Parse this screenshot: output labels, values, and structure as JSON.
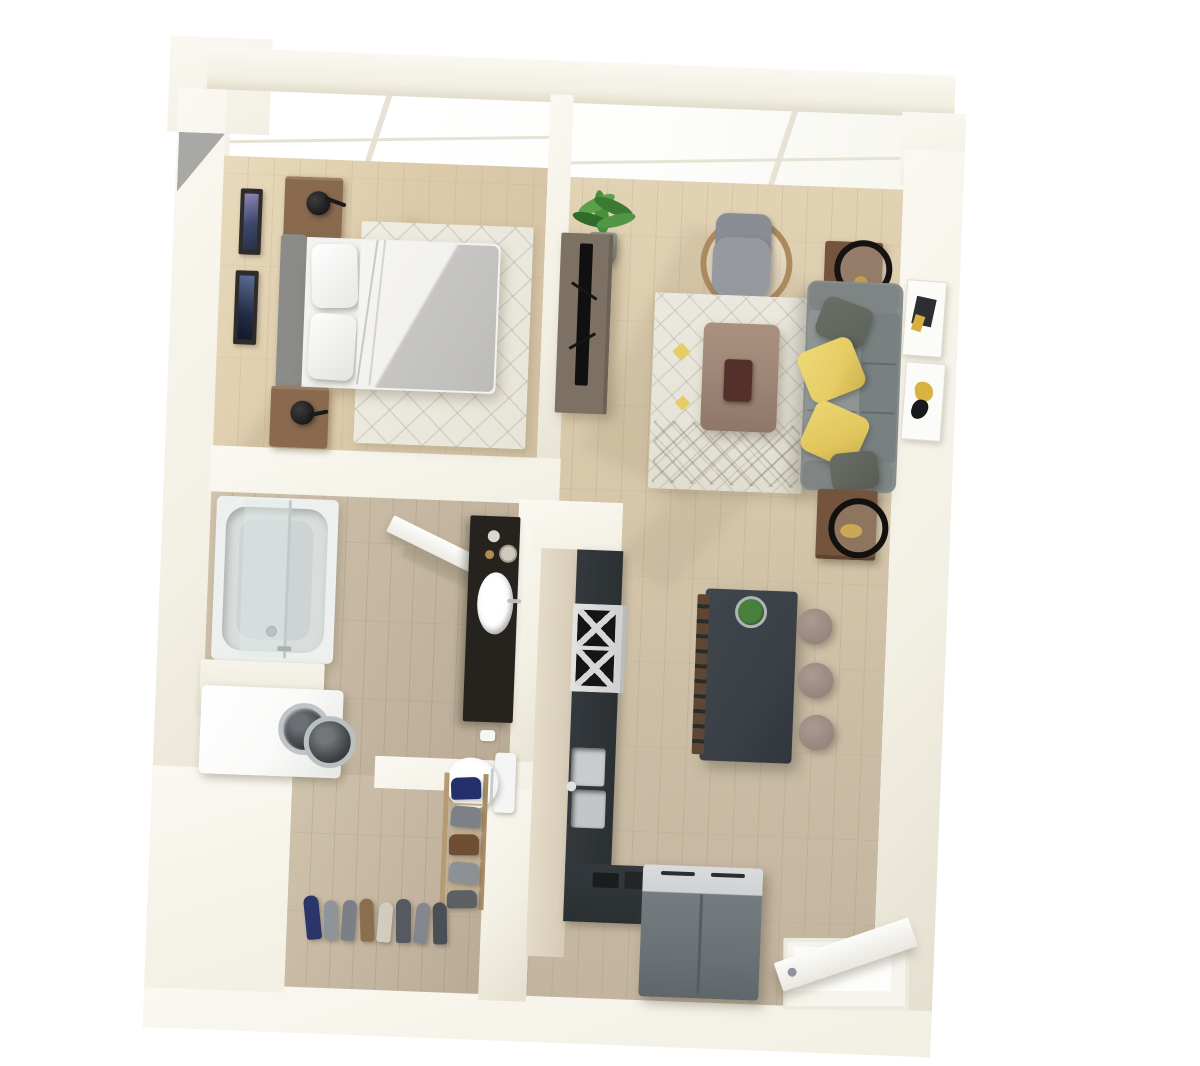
{
  "scene": {
    "type": "3d-floor-plan-render",
    "description": "Top-down 3D rendering of a one-bedroom apartment with bedroom, living room, bathroom with laundry, closet, kitchen and entry",
    "background": "#ffffff"
  },
  "palette": {
    "background": "#ffffff",
    "wall": "#f2efe3",
    "wall_bright": "#faf8f1",
    "wall_shadow": "#e4dfcf",
    "wall_wedge": "#a8a8a6",
    "glass": "#fdfdfb",
    "mullion": "#e6e2d4",
    "floor_oak": "#dccbab",
    "floor_taupe": "#c5b7a1",
    "rug_cream": "#ebe9df",
    "accent_orange": "#d87f4a",
    "sofa_gray": "#878d8b",
    "sofa_gray_dark": "#798080",
    "pillow_yellow": "#e6cc64",
    "pillow_olive": "#5d625a",
    "nightstand_brown": "#8a6a4e",
    "sidetable_brown": "#74543c",
    "console_taupe": "#7c7163",
    "table_mauve": "#a18878",
    "tray_maroon": "#54302a",
    "island_charcoal": "#3a4046",
    "counter_charcoal": "#2e3336",
    "cabinet_light": "#ddd3c0",
    "stool_taupe": "#9c8b82",
    "stainless": "#c9cccd",
    "fridge_gray": "#757c80",
    "appliance_white": "#fafaf9",
    "fixture_white": "#f4f5f4",
    "tub_inner": "#d9dedd",
    "vanity_black": "#26221e",
    "tv_black": "#101010",
    "plant_green": "#477f3b",
    "brass": "#c2a14e",
    "chair_gray": "#96999f",
    "rattan": "#ab8a5f",
    "headboard_gray": "#8b8b89",
    "duvet_gray": "#c6c5c3",
    "mattress_white": "#f3f2f0"
  },
  "closet": {
    "rack_shoe_colors": [
      "#23306b",
      "#7d8187",
      "#6e4f33",
      "#8d9196",
      "#5c6063"
    ],
    "floor_shoe_colors": [
      "#2b3569",
      "#8f939a",
      "#7b7f88",
      "#8a6e4e",
      "#d2ccbf",
      "#565a60",
      "#84888e",
      "#4a4e55"
    ]
  },
  "rooms": [
    {
      "id": "bedroom",
      "furniture": [
        "bed",
        "headboard",
        "pillows",
        "duvet",
        "nightstand-left",
        "nightstand-right",
        "table-lamp",
        "table-lamp",
        "area-rug",
        "wall-frame",
        "wall-frame"
      ]
    },
    {
      "id": "living-room",
      "furniture": [
        "sofa",
        "yellow-throw-pillows",
        "gray-throw-pillows",
        "coffee-table",
        "decor-tray",
        "area-rug",
        "accent-chair",
        "tv-console",
        "tv",
        "side-table",
        "side-table",
        "ring-decor",
        "potted-plant",
        "wall-art",
        "wall-art"
      ]
    },
    {
      "id": "bathroom",
      "furniture": [
        "bathtub",
        "glass-screen",
        "open-door",
        "vanity",
        "vessel-sink",
        "toilet",
        "toilet-paper-holder",
        "washer",
        "dryer",
        "laundry-counter"
      ]
    },
    {
      "id": "kitchen",
      "furniture": [
        "counter-run",
        "gas-cooktop",
        "double-sink",
        "l-counter",
        "refrigerator",
        "island",
        "bar-stool",
        "bar-stool",
        "bar-stool",
        "island-plant"
      ]
    },
    {
      "id": "closet",
      "furniture": [
        "shoe-rack",
        "shoe-row"
      ]
    },
    {
      "id": "entry",
      "furniture": [
        "front-door-open",
        "threshold"
      ]
    }
  ],
  "windows": {
    "style": "floor-to-ceiling-glazing",
    "location": "top wall across bedroom and living room",
    "panel_groups": 2
  }
}
